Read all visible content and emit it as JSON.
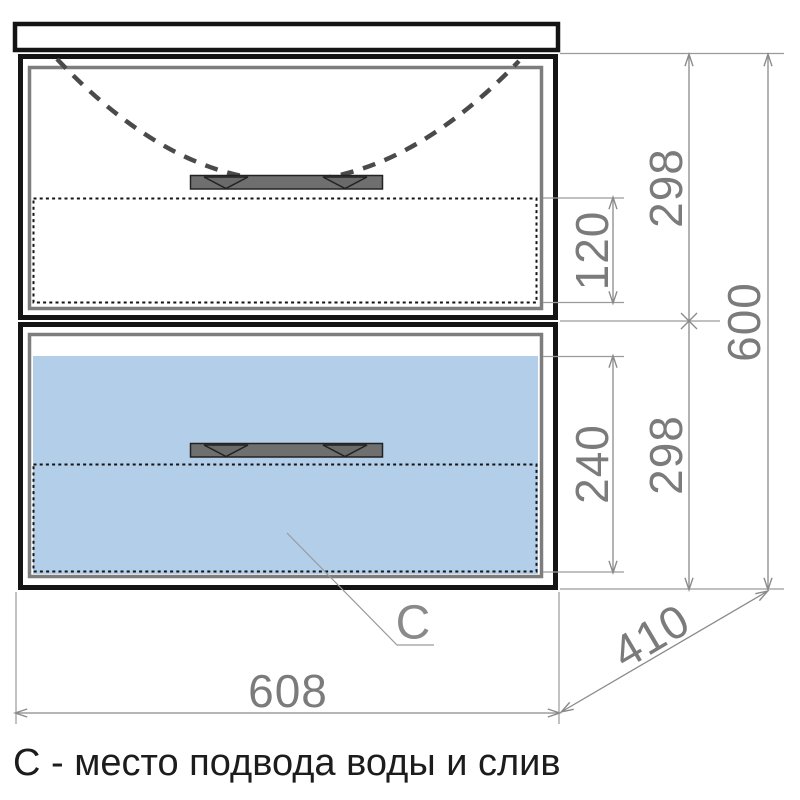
{
  "title": "Vanity cabinet front-view dimension drawing",
  "caption": "С - место подвода воды и слив",
  "leader": {
    "label": "C"
  },
  "dimensions": {
    "top_drawer_height": "298",
    "top_service_zone": "120",
    "bottom_drawer_height": "298",
    "bottom_service_zone": "240",
    "total_height": "600",
    "width": "608",
    "depth": "410"
  },
  "colors": {
    "drawer_fill": "#b2cee9",
    "outline": "#141414",
    "panel_gray": "#7d7d7d",
    "handle_gray": "#6f6f6f",
    "dimension_gray": "#8a8a8a",
    "caption_black": "#1c1c1c"
  }
}
